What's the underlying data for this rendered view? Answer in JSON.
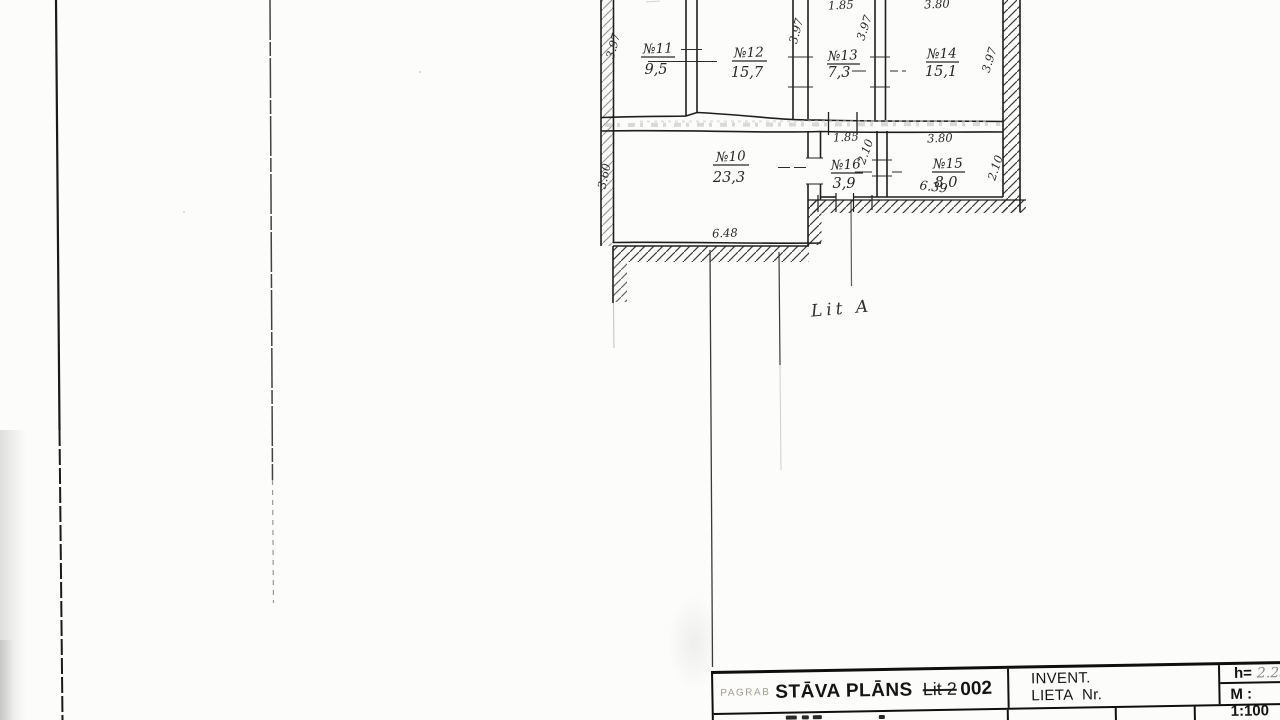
{
  "plan": {
    "annotation": "Lit A",
    "rooms": [
      {
        "number": "№11",
        "area": "9,5"
      },
      {
        "number": "№12",
        "area": "15,7"
      },
      {
        "number": "№13",
        "area": "7,3"
      },
      {
        "number": "№14",
        "area": "15,1"
      },
      {
        "number": "№10",
        "area": "23,3"
      },
      {
        "number": "№16",
        "area": "3,9"
      },
      {
        "number": "№15",
        "area": "8,0"
      }
    ],
    "dims": [
      "1.85",
      "3.80",
      "3.97",
      "3.97",
      "3.97",
      "3.97",
      "3.60",
      "6.48",
      "1.85",
      "2.10",
      "3.80",
      "2.10",
      "6.39"
    ]
  },
  "title_block": {
    "stamp": "PAGRAB",
    "title": "STĀVA PLĀNS",
    "struck": "Lit 2",
    "number": "002",
    "invent_line1": "INVENT.",
    "invent_line2": "LIETA Nr.",
    "height_label": "h=",
    "height_value": "2.25",
    "scale": "M : 1:100"
  },
  "colors": {
    "paper": "#fcfcfb",
    "ink": "#1c1c1c",
    "stamp_gray": "#a39d94",
    "handwriting_gray": "#8c8c8c"
  }
}
